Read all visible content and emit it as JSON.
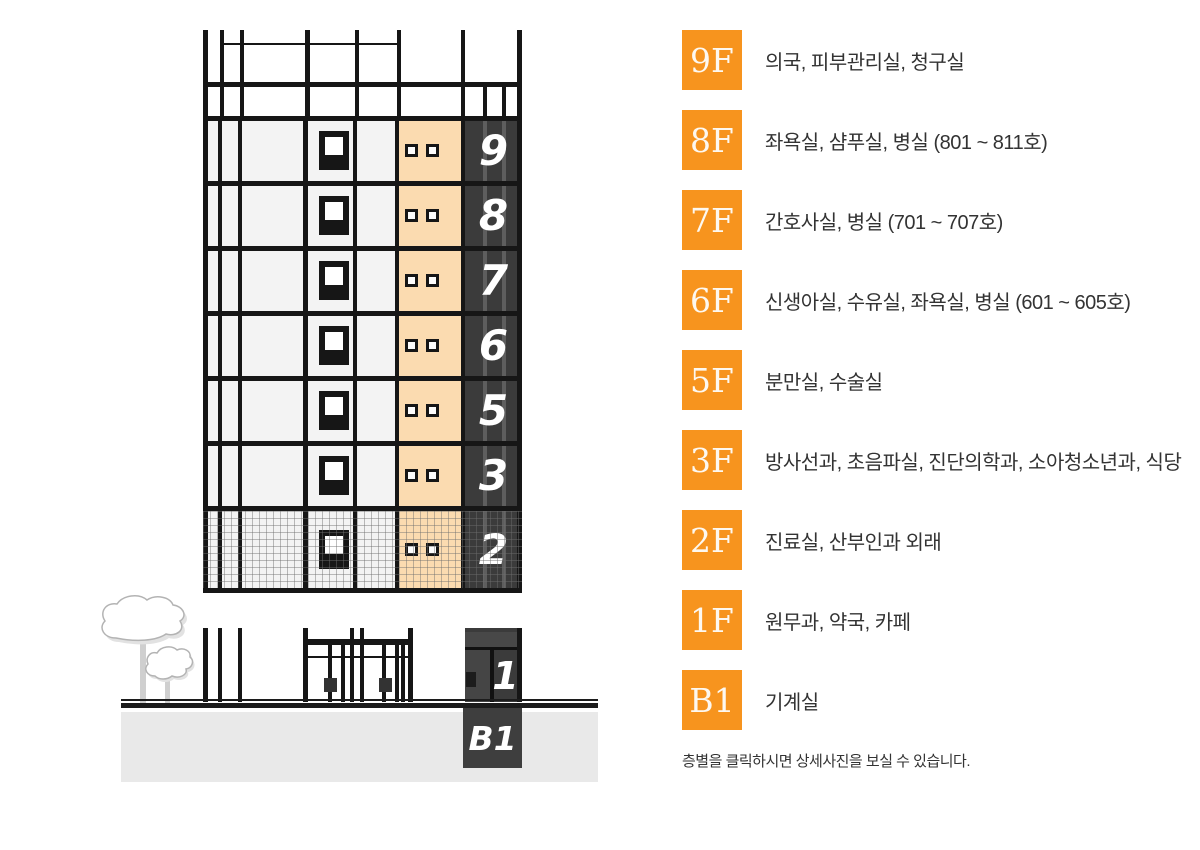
{
  "colors": {
    "badge_orange": "#F7941E",
    "peach_panel": "#FBDBB0",
    "dark_panel": "#3B3B3B",
    "line_black": "#161616",
    "floor_gray": "#F3F3F3",
    "ground_gray": "#E9E9E9",
    "text_dark": "#333333"
  },
  "building": {
    "upper_floors": [
      {
        "number": "9",
        "textured": false
      },
      {
        "number": "8",
        "textured": false
      },
      {
        "number": "7",
        "textured": false
      },
      {
        "number": "6",
        "textured": false
      },
      {
        "number": "5",
        "textured": false
      },
      {
        "number": "3",
        "textured": false
      },
      {
        "number": "2",
        "textured": true
      }
    ],
    "ground_floor": {
      "number": "1"
    },
    "basement": {
      "number": "B1"
    }
  },
  "directory": {
    "items": [
      {
        "badge": "9F",
        "description": "의국, 피부관리실, 청구실"
      },
      {
        "badge": "8F",
        "description": "좌욕실, 샴푸실, 병실 (801 ~ 811호)"
      },
      {
        "badge": "7F",
        "description": "간호사실, 병실 (701 ~ 707호)"
      },
      {
        "badge": "6F",
        "description": "신생아실, 수유실, 좌욕실, 병실 (601 ~ 605호)"
      },
      {
        "badge": "5F",
        "description": "분만실, 수술실"
      },
      {
        "badge": "3F",
        "description": "방사선과, 초음파실, 진단의학과, 소아청소년과, 식당"
      },
      {
        "badge": "2F",
        "description": "진료실, 산부인과 외래"
      },
      {
        "badge": "1F",
        "description": "원무과, 약국, 카페"
      },
      {
        "badge": "B1",
        "description": "기계실"
      }
    ],
    "note": "층별을 클릭하시면 상세사진을 보실 수 있습니다."
  }
}
